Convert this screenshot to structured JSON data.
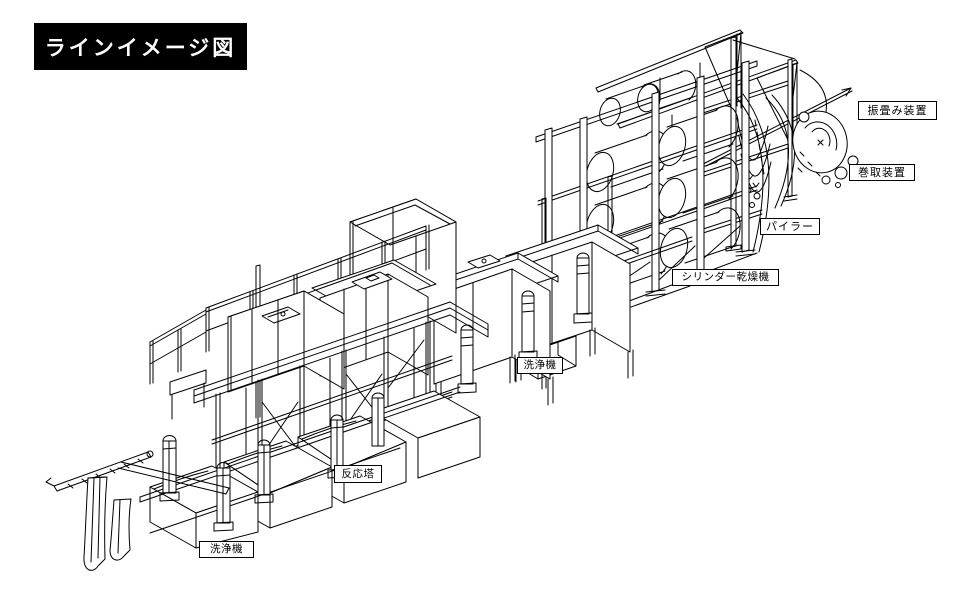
{
  "title": "ラインイメージ図",
  "labels": {
    "washer_entry": "洗浄機",
    "reaction_tower": "反応塔",
    "washer_mid": "洗浄機",
    "cylinder_dryer": "シリンダー乾燥機",
    "piler": "パイラー",
    "winder": "巻取装置",
    "folding": "振畳み装置"
  },
  "colors": {
    "line": "#000000",
    "background": "#ffffff",
    "title_bg": "#000000",
    "title_fg": "#ffffff",
    "label_border": "#000000",
    "label_bg": "#ffffff"
  },
  "diagram": {
    "type": "isometric_line_drawing",
    "flow_order": [
      "洗浄機",
      "反応塔",
      "洗浄機",
      "シリンダー乾燥機",
      "パイラー",
      "巻取装置",
      "振畳み装置"
    ]
  }
}
